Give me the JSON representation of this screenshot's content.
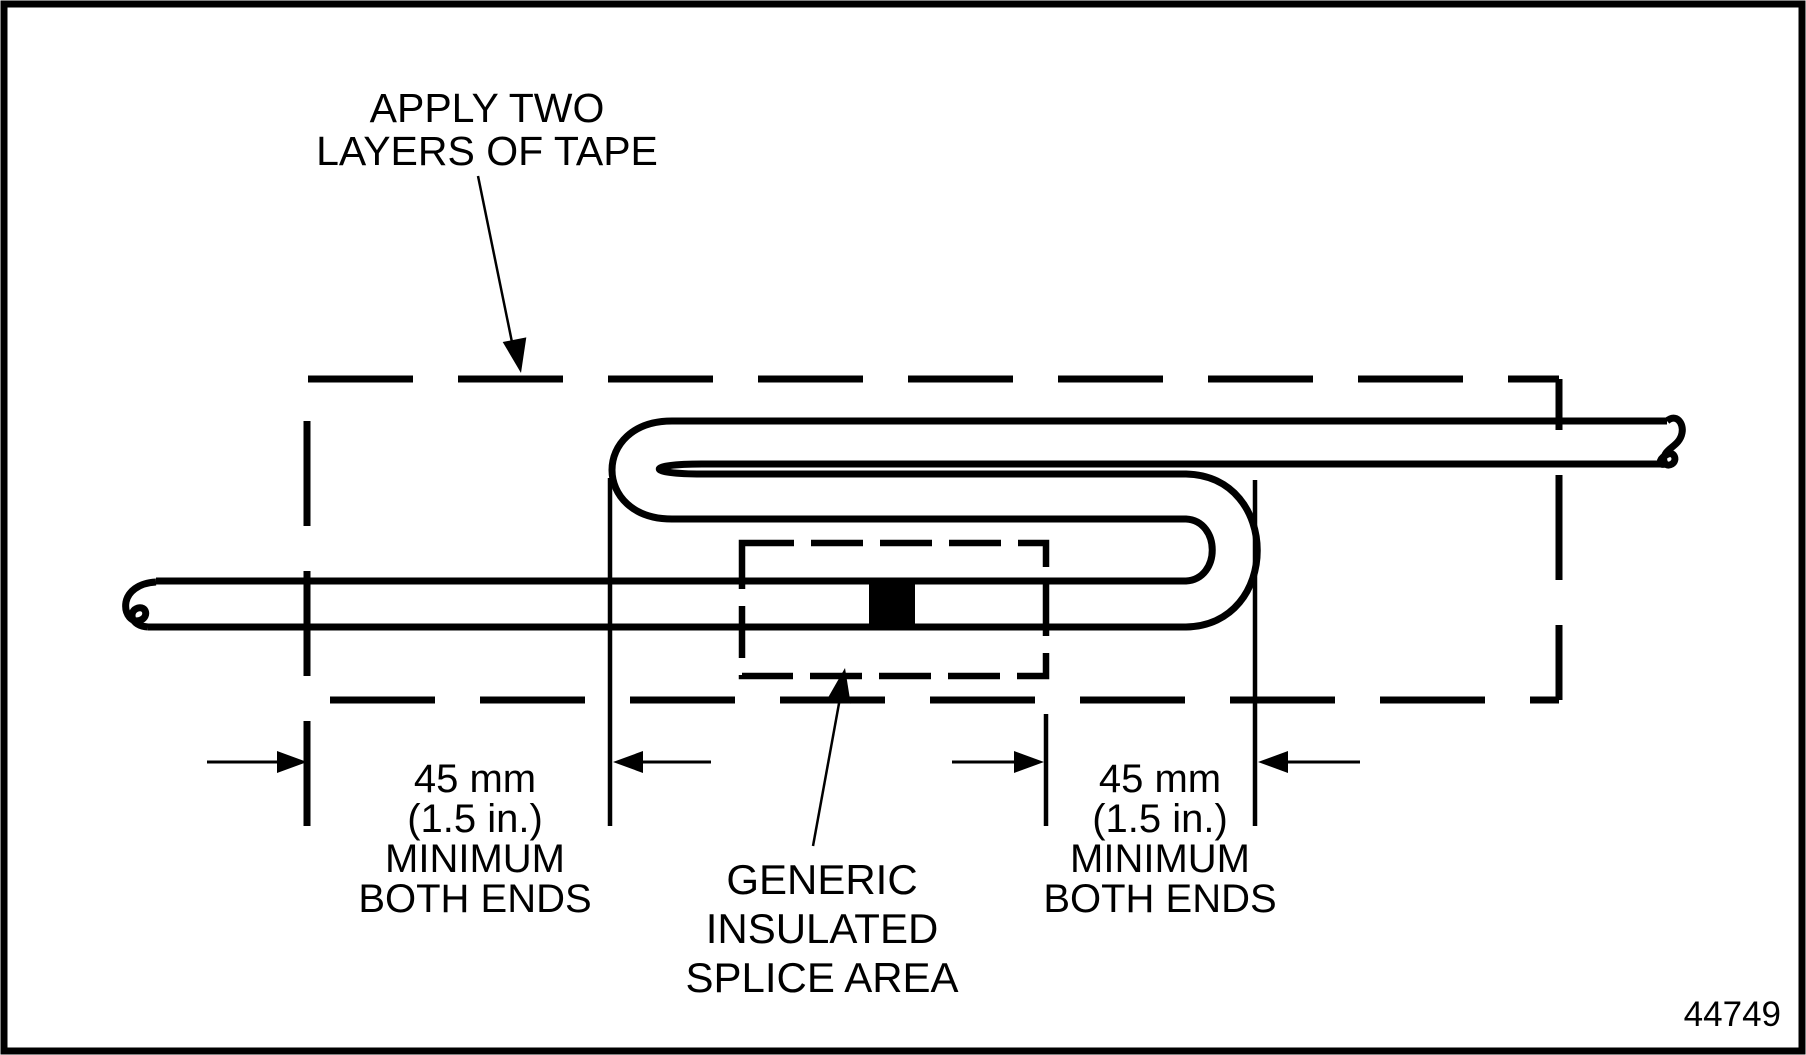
{
  "diagram": {
    "apply_tape_label": {
      "line1": "APPLY TWO",
      "line2": "LAYERS OF TAPE"
    },
    "left_dimension_label": {
      "line1": "45 mm",
      "line2": "(1.5 in.)",
      "line3": "MINIMUM",
      "line4": "BOTH ENDS"
    },
    "right_dimension_label": {
      "line1": "45 mm",
      "line2": "(1.5 in.)",
      "line3": "MINIMUM",
      "line4": "BOTH ENDS"
    },
    "splice_label": {
      "line1": "GENERIC",
      "line2": "INSULATED",
      "line3": "SPLICE AREA"
    },
    "figure_number": "44749",
    "colors": {
      "ink": "#000000",
      "paper": "#ffffff"
    }
  }
}
